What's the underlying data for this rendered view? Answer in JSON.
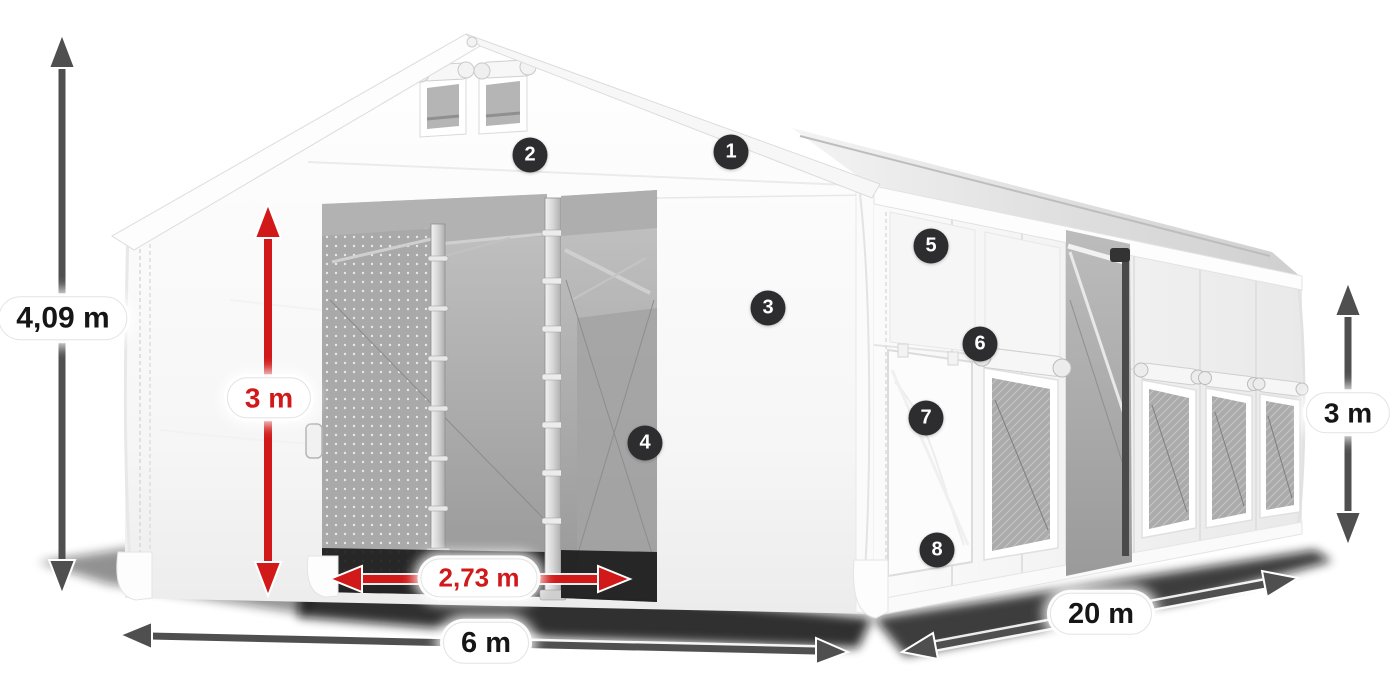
{
  "canvas": {
    "background": "#ffffff",
    "width_px": 1400,
    "height_px": 700
  },
  "colors": {
    "canvas_background": "#ffffff",
    "dimension_red": "#d11919",
    "dimension_gray": "#4f4f4f",
    "marker_background": "#2d2d2f",
    "marker_number": "#ffffff",
    "pill_background": "#ffffff",
    "pill_text": "#161616",
    "fabric_white": "#ffffff",
    "interior_gray": "#a8a8a8"
  },
  "dimensions": {
    "total_height": {
      "label": "4,09 m",
      "style": "gray"
    },
    "door_height": {
      "label": "3 m",
      "style": "red"
    },
    "door_width": {
      "label": "2,73 m",
      "style": "red"
    },
    "tent_width": {
      "label": "6 m",
      "style": "gray"
    },
    "tent_length": {
      "label": "20 m",
      "style": "gray"
    },
    "side_wall_height": {
      "label": "3 m",
      "style": "gray"
    }
  },
  "hotspots": [
    {
      "number": "1"
    },
    {
      "number": "2"
    },
    {
      "number": "3"
    },
    {
      "number": "4"
    },
    {
      "number": "5"
    },
    {
      "number": "6"
    },
    {
      "number": "7"
    },
    {
      "number": "8"
    }
  ]
}
